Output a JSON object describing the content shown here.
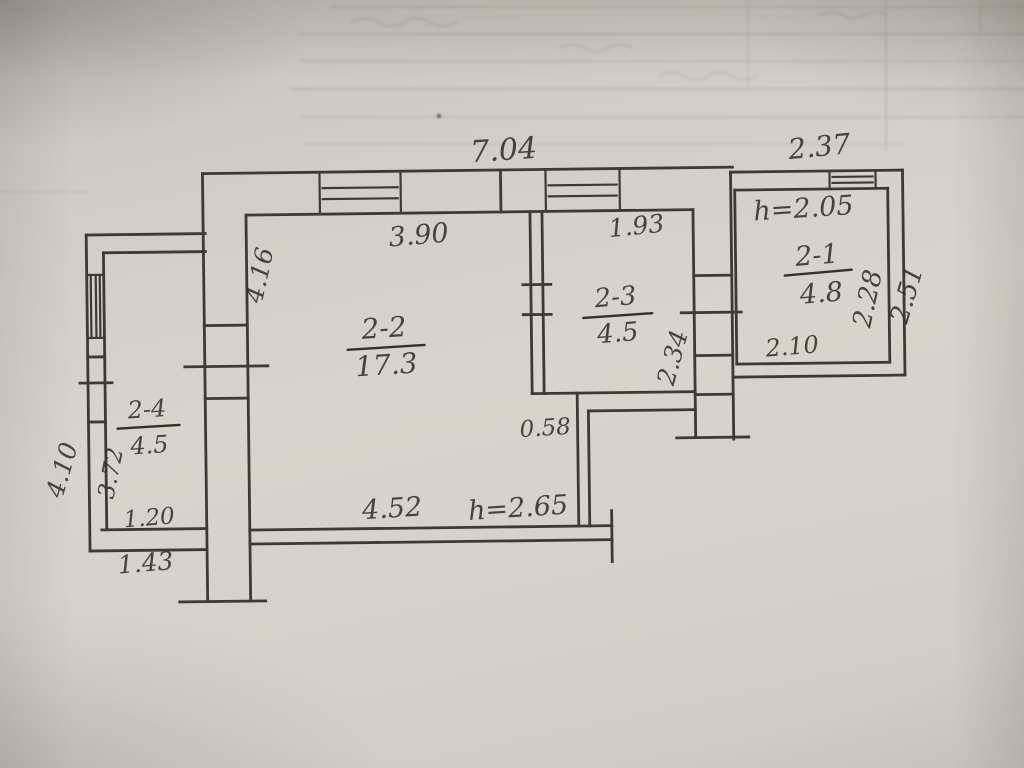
{
  "floor_plan": {
    "rooms": [
      {
        "number": "2-1",
        "area": "4.8"
      },
      {
        "number": "2-2",
        "area": "17.3"
      },
      {
        "number": "2-3",
        "area": "4.5"
      },
      {
        "number": "2-4",
        "area": "4.5"
      }
    ],
    "ceiling_heights": {
      "right_room": "h=2.05",
      "main_room": "h=2.65"
    },
    "dimensions": {
      "top_total": "7.04",
      "top_right": "2.37",
      "room22_width": "3.90",
      "room23_width": "1.93",
      "room22_left_height": "4.16",
      "room21_inner_height": "2.28",
      "right_outer_height": "2.51",
      "room21_bottom_width": "2.10",
      "corridor_wall_height": "2.34",
      "stub_wall": "0.58",
      "bottom_inner_width": "4.52",
      "annex_outer_height": "4.10",
      "annex_inner_height": "3.72",
      "annex_bottom_inner": "1.20",
      "annex_bottom_outer": "1.43"
    }
  }
}
